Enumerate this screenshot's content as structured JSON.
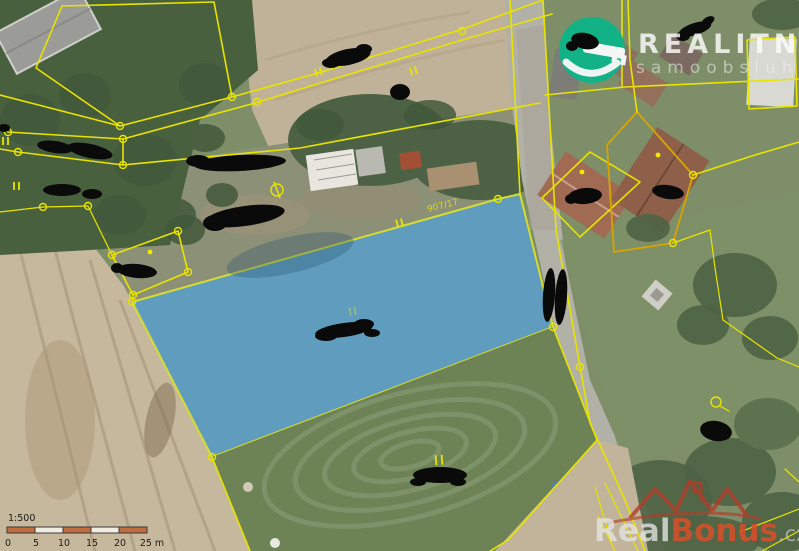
{
  "map": {
    "parcel_label": "907/17",
    "highlight_color": "#5b9ec9",
    "boundary_color": "#e8e400",
    "secondary_boundary_color": "#d9a400"
  },
  "logo": {
    "brand": "REALITNÍ",
    "tagline": "samoobsluha",
    "circle_color": "#12b286"
  },
  "watermark": {
    "part1": "Real",
    "part2": "Bonus",
    "part3": ".cz",
    "accent_color": "#d4502a",
    "roof_color": "#b23c28"
  },
  "scalebar": {
    "ratio": "1:500",
    "bar_color": "#bf6f3f",
    "ticks": [
      "0",
      "5",
      "10",
      "15",
      "20",
      "25 m"
    ]
  }
}
